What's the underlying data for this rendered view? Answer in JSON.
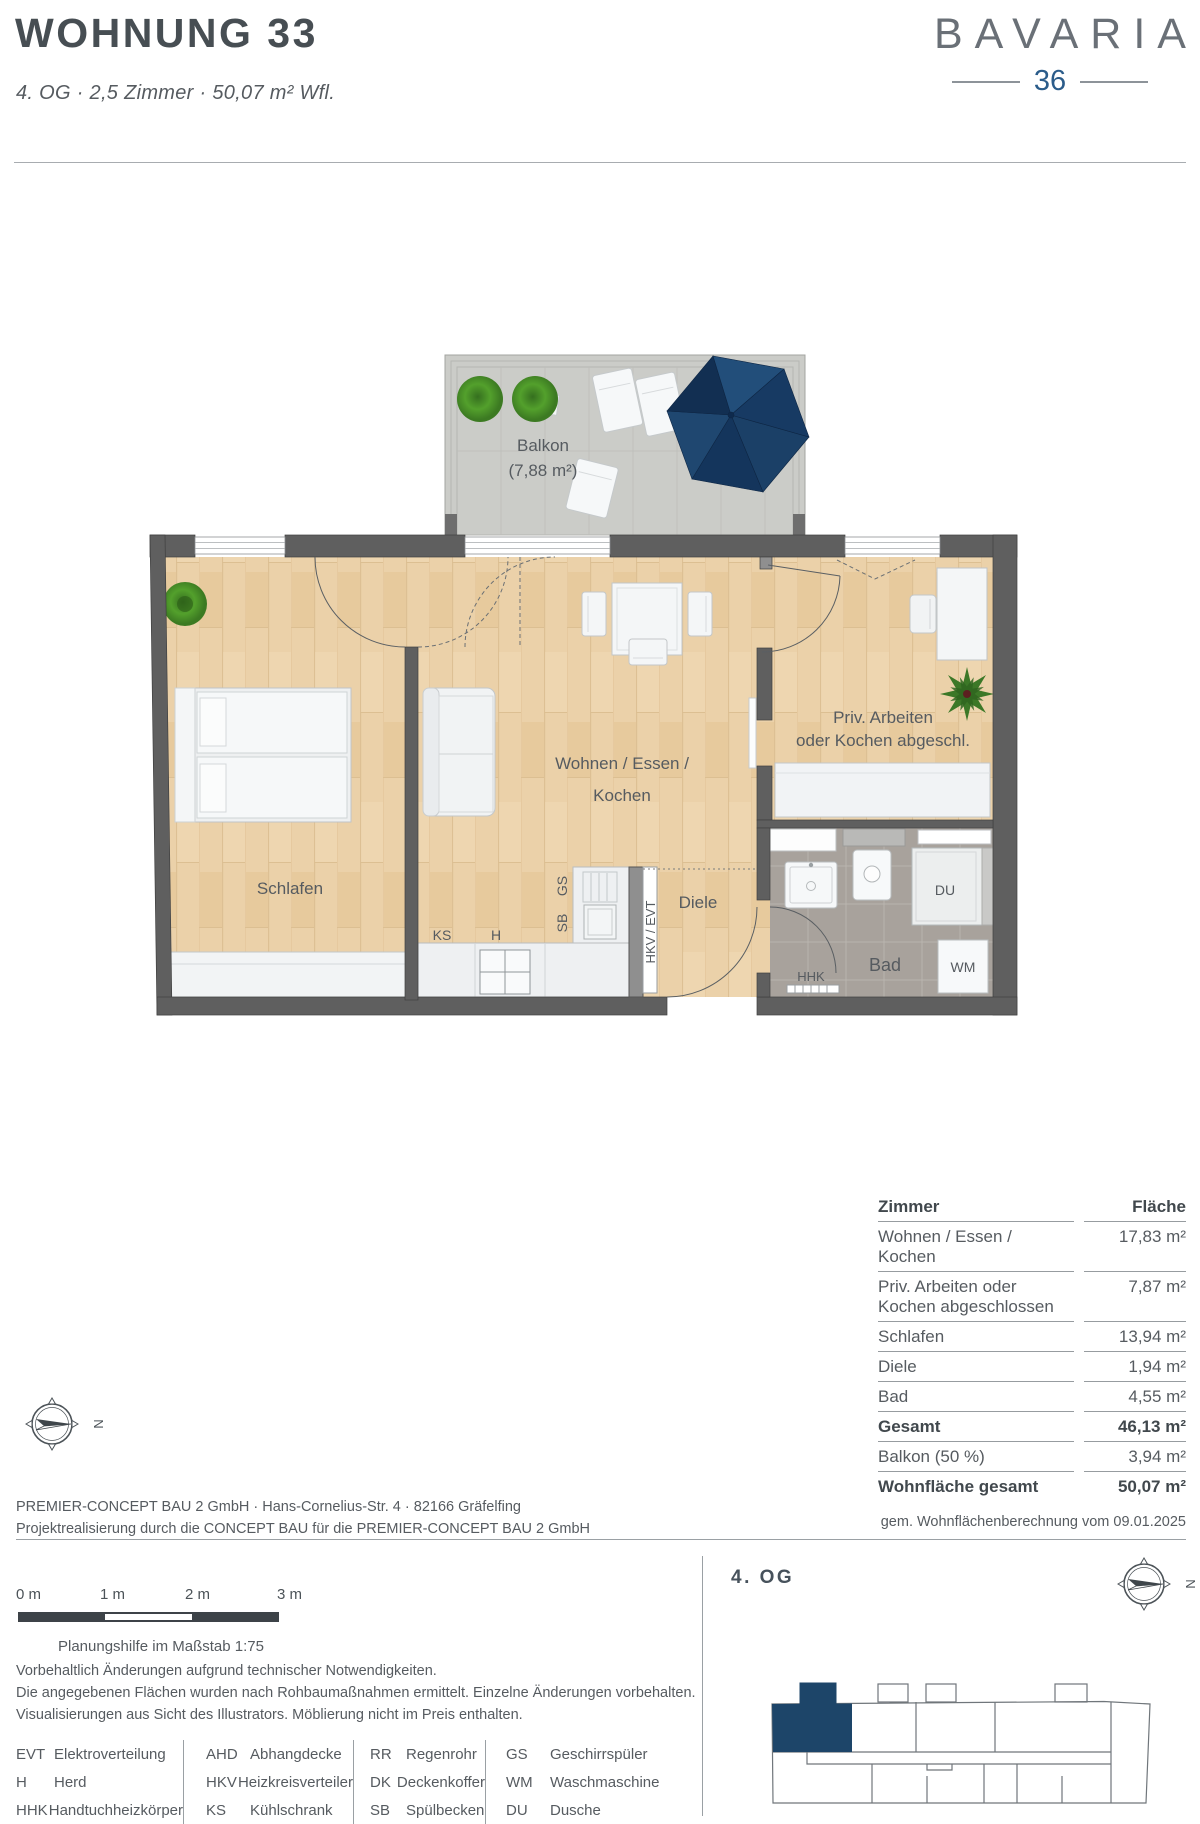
{
  "header": {
    "title": "WOHNUNG 33",
    "subtitle": "4. OG · 2,5 Zimmer · 50,07 m² Wfl."
  },
  "logo": {
    "name": "BAVARIA",
    "number": "36"
  },
  "plan": {
    "balcony": {
      "label": "Balkon",
      "area": "(7,88 m²)"
    },
    "rooms": {
      "living_line1": "Wohnen / Essen /",
      "living_line2": "Kochen",
      "priv_line1": "Priv. Arbeiten",
      "priv_line2": "oder Kochen abgeschl.",
      "bedroom": "Schlafen",
      "hall": "Diele",
      "bath": "Bad"
    },
    "fixtures": {
      "ks": "KS",
      "h": "H",
      "sb": "SB",
      "gs": "GS",
      "hkv_evt": "HKV / EVT",
      "hhk": "HHK",
      "du": "DU",
      "wm": "WM"
    }
  },
  "area_table": {
    "col_room": "Zimmer",
    "col_area": "Fläche",
    "rows": [
      {
        "label": "Wohnen / Essen / Kochen",
        "value": "17,83 m²"
      },
      {
        "label": "Priv. Arbeiten oder",
        "label2": "Kochen abgeschlossen",
        "value": "7,87 m²"
      },
      {
        "label": "Schlafen",
        "value": "13,94 m²"
      },
      {
        "label": "Diele",
        "value": "1,94 m²"
      },
      {
        "label": "Bad",
        "value": "4,55 m²"
      },
      {
        "label": "Gesamt",
        "value": "46,13 m²"
      },
      {
        "label": "Balkon (50 %)",
        "value": "3,94 m²"
      },
      {
        "label": "Wohnfläche gesamt",
        "value": "50,07 m²"
      }
    ]
  },
  "footer": {
    "company_line1": "PREMIER-CONCEPT BAU 2 GmbH · Hans-Cornelius-Str. 4 · 82166 Gräfelfing",
    "company_line2": "Projektrealisierung durch die CONCEPT BAU für die PREMIER-CONCEPT BAU 2 GmbH",
    "calc_note": "gem. Wohnflächenberechnung vom 09.01.2025",
    "scale_bar": {
      "labels": [
        "0 m",
        "1 m",
        "2 m",
        "3 m"
      ],
      "caption": "Planungshilfe im Maßstab 1:75"
    },
    "floor_label": "4. OG",
    "compass_letter": "N",
    "disclaimer": [
      "Vorbehaltlich Änderungen aufgrund technischer Notwendigkeiten.",
      "Die angegebenen Flächen wurden nach Rohbaumaßnahmen ermittelt. Einzelne Änderungen vorbehalten.",
      "Visualisierungen aus Sicht des Illustrators. Möblierung nicht im Preis enthalten."
    ],
    "legend": [
      [
        {
          "abbr": "EVT",
          "term": "Elektroverteilung"
        },
        {
          "abbr": "H",
          "term": "Herd"
        },
        {
          "abbr": "HHK",
          "term": "Handtuchheizkörper"
        }
      ],
      [
        {
          "abbr": "AHD",
          "term": "Abhangdecke"
        },
        {
          "abbr": "HKV",
          "term": "Heizkreisverteiler"
        },
        {
          "abbr": "KS",
          "term": "Kühlschrank"
        }
      ],
      [
        {
          "abbr": "RR",
          "term": "Regenrohr"
        },
        {
          "abbr": "DK",
          "term": "Deckenkoffer"
        },
        {
          "abbr": "SB",
          "term": "Spülbecken"
        }
      ],
      [
        {
          "abbr": "GS",
          "term": "Geschirrspüler"
        },
        {
          "abbr": "WM",
          "term": "Waschmaschine"
        },
        {
          "abbr": "DU",
          "term": "Dusche"
        }
      ]
    ]
  },
  "colors": {
    "accent_navy": "#1d4569",
    "logo_blue": "#2b5c8a",
    "wall_gray": "#5f5f5f",
    "floor_wood": "#ebd1a9",
    "bath_tile": "#a8a29c"
  }
}
